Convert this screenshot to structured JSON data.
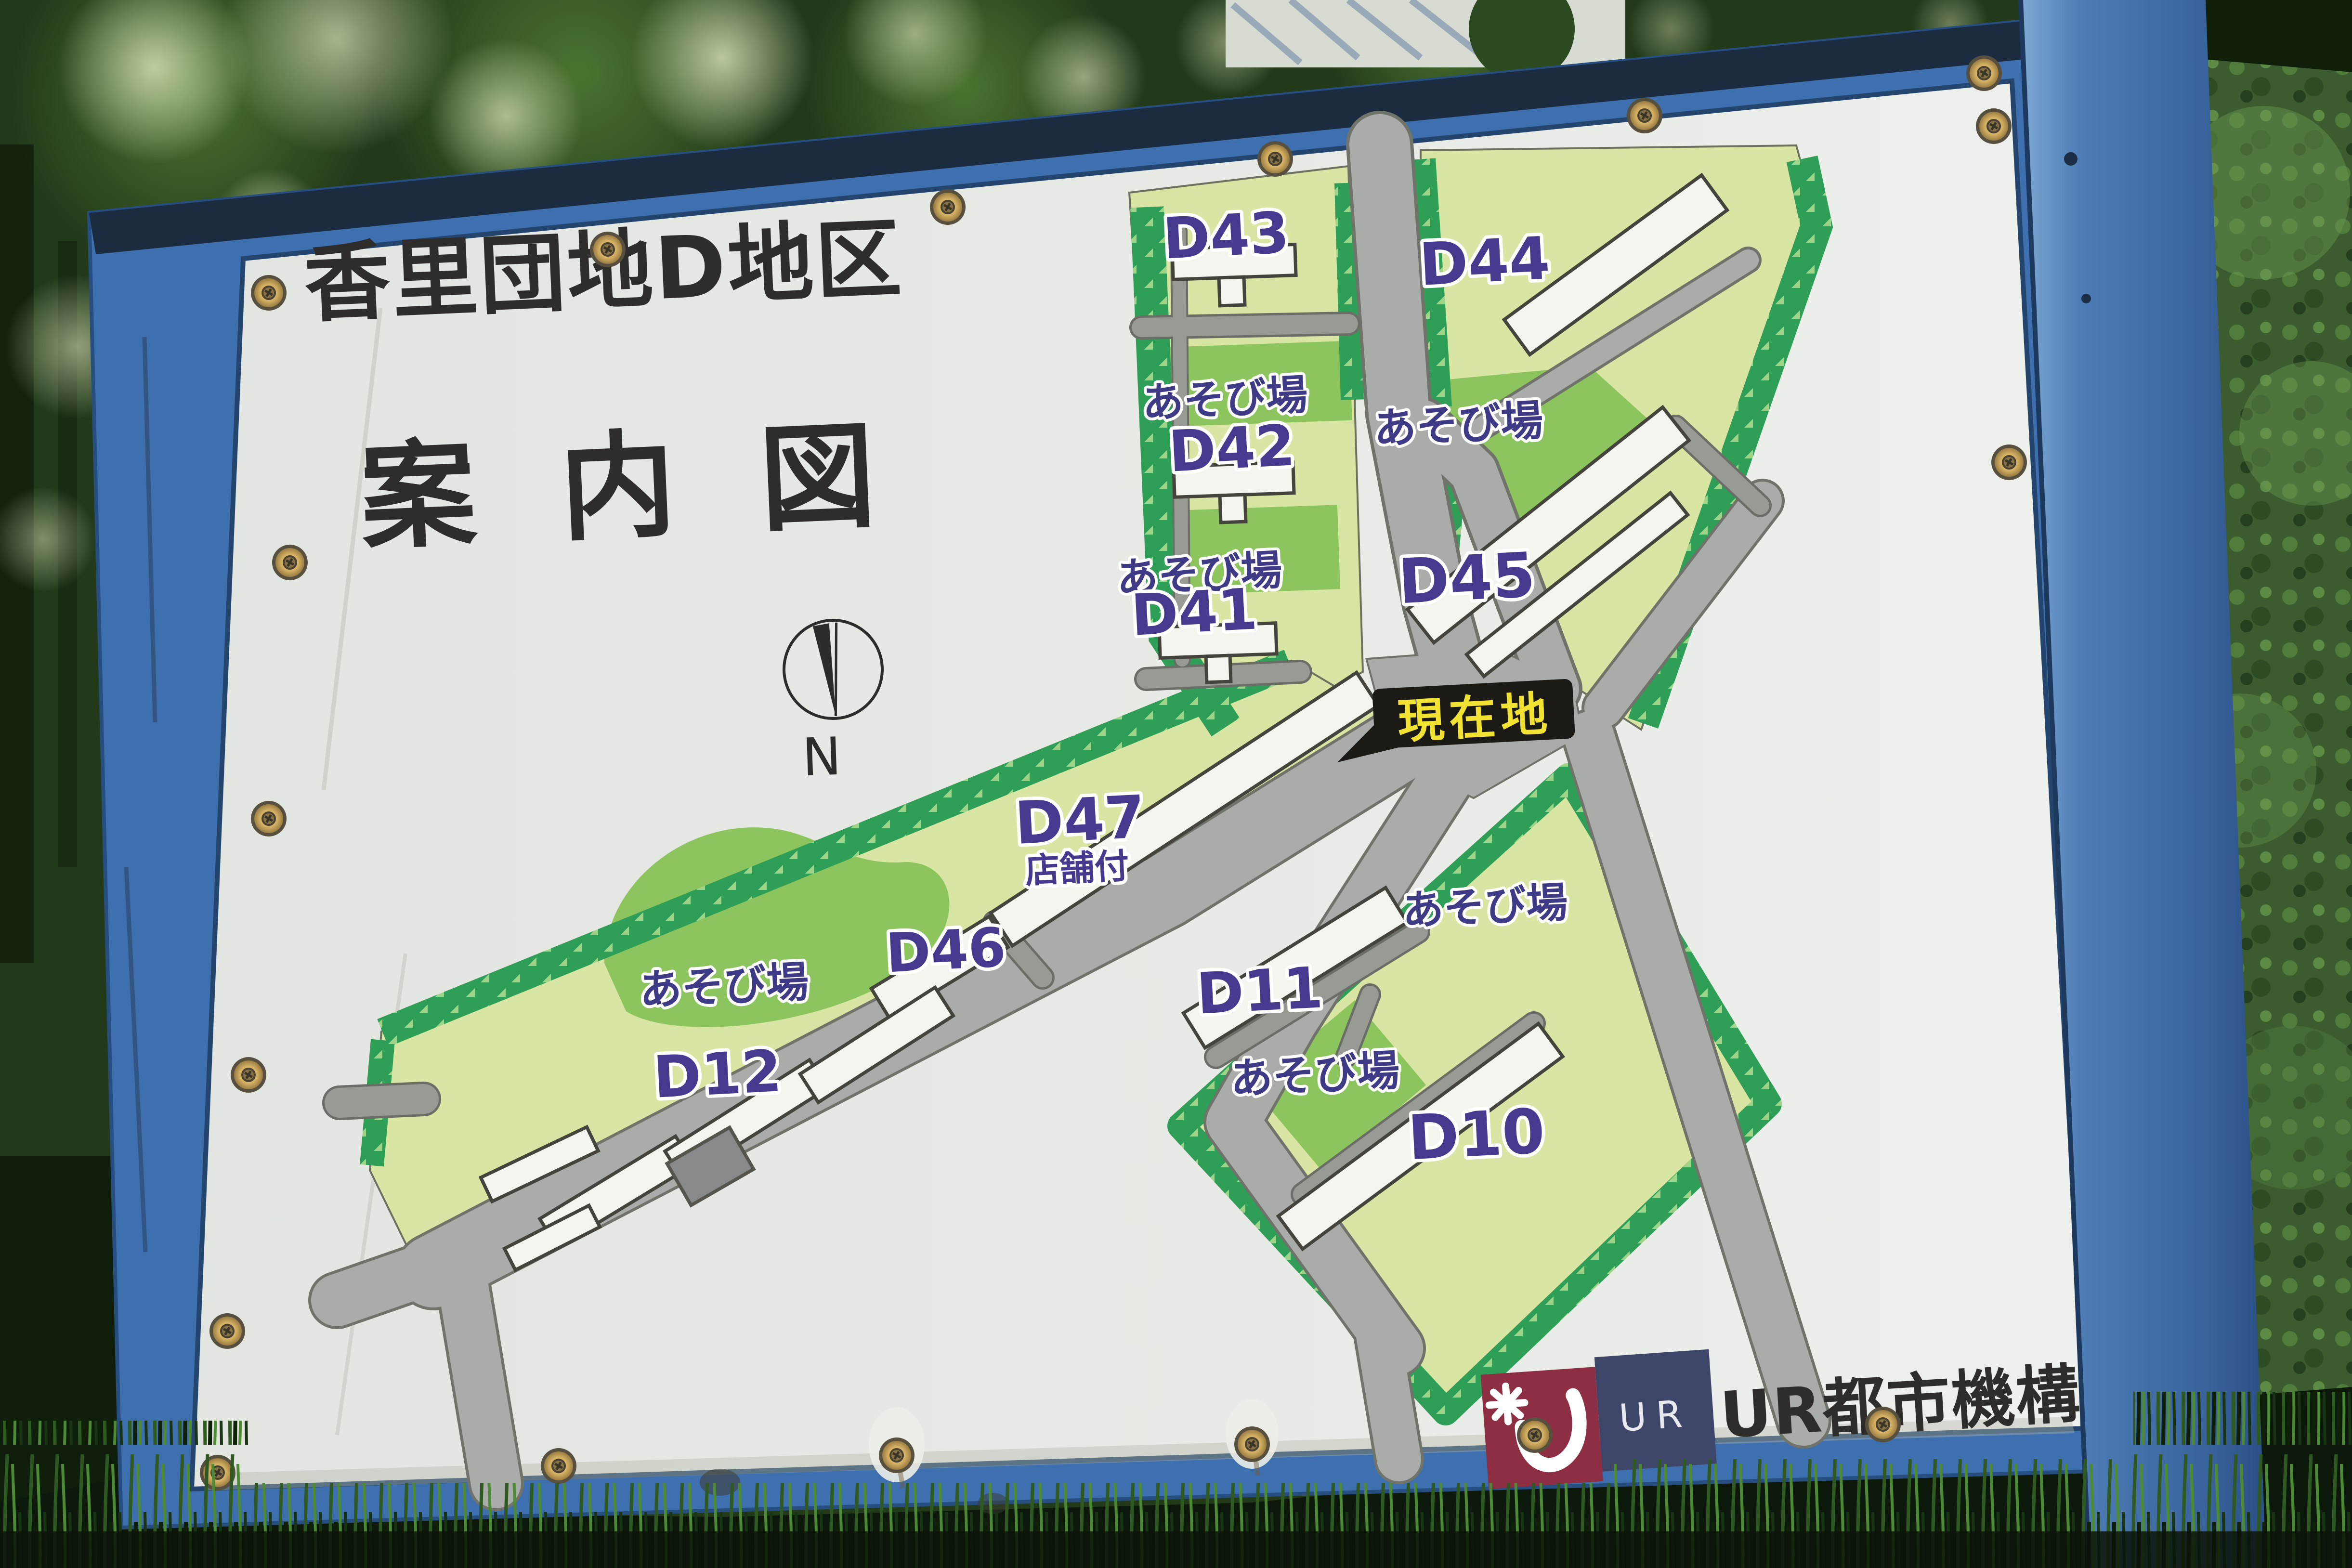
{
  "sign": {
    "title": {
      "line1": "香里団地D地区",
      "line2": "案内図"
    },
    "compass": {
      "label": "N"
    },
    "marker": {
      "label": "現在地"
    },
    "map": {
      "playground_label": "あそび場",
      "buildings": [
        {
          "id": "D43"
        },
        {
          "id": "D44"
        },
        {
          "id": "D42"
        },
        {
          "id": "D45"
        },
        {
          "id": "D41"
        },
        {
          "id": "D47",
          "annotation": "店舗付"
        },
        {
          "id": "D46"
        },
        {
          "id": "D12"
        },
        {
          "id": "D11"
        },
        {
          "id": "D10"
        }
      ]
    },
    "footer": {
      "logo_initials": "UR",
      "org_name": "UR都市機構"
    },
    "colors": {
      "frame_blue": "#3e6fae",
      "post_blue": "#4a79b8",
      "panel": "#e6e8e3",
      "road": "#a9aca9",
      "parcel": "#d9e5a2",
      "parcel_border": "#2f9e57",
      "playground": "#8cc45e",
      "building": "#f5f5f0",
      "label_purple": "#453a8e",
      "title_ink": "#2e2d2b",
      "marker_bg": "#1b1a14",
      "marker_text": "#f2e232",
      "logo_maroon": "#8d2e43",
      "logo_navy": "#3d4668"
    }
  }
}
